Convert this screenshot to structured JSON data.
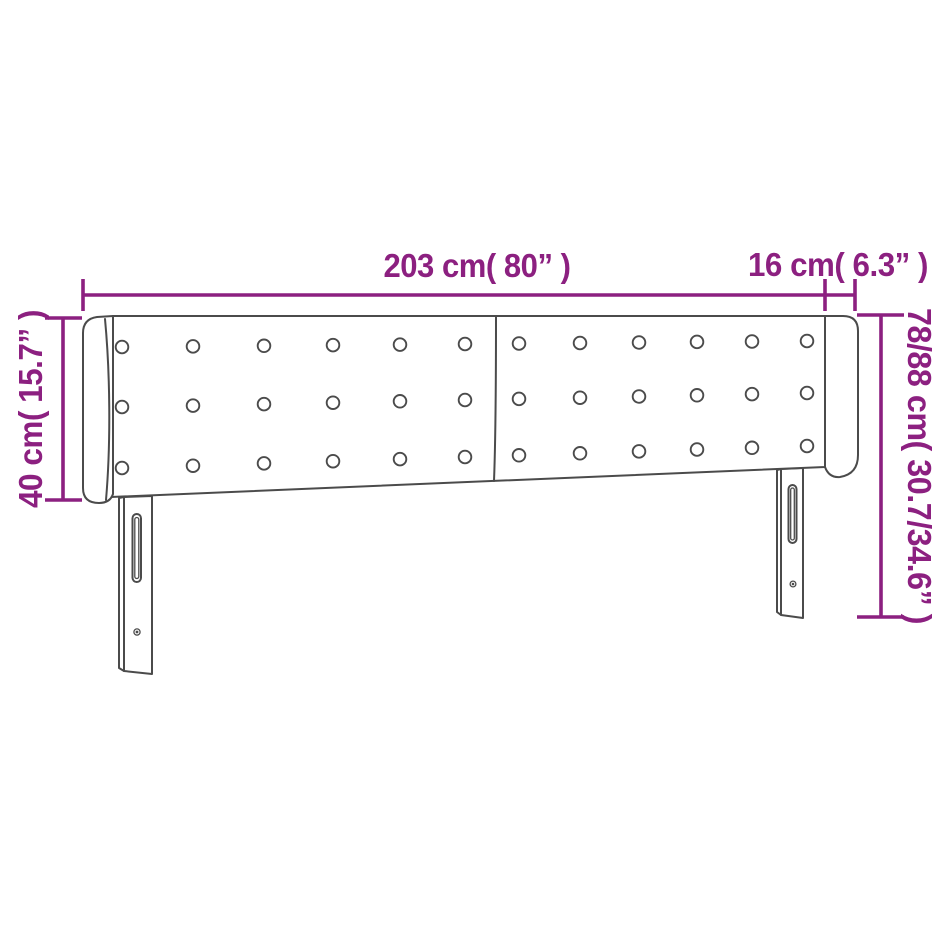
{
  "diagram": {
    "kind": "headboard-dimension-diagram",
    "colors": {
      "dimension": "#8c2080",
      "outline": "#4b4b4b",
      "background": "#ffffff"
    },
    "dimensions": {
      "total_width": "203 cm( 80” )",
      "wing_depth": "16 cm( 6.3” )",
      "headboard_height": "40 cm( 15.7” )",
      "total_height": "78/88 cm( 30.7/34.6” )"
    }
  }
}
